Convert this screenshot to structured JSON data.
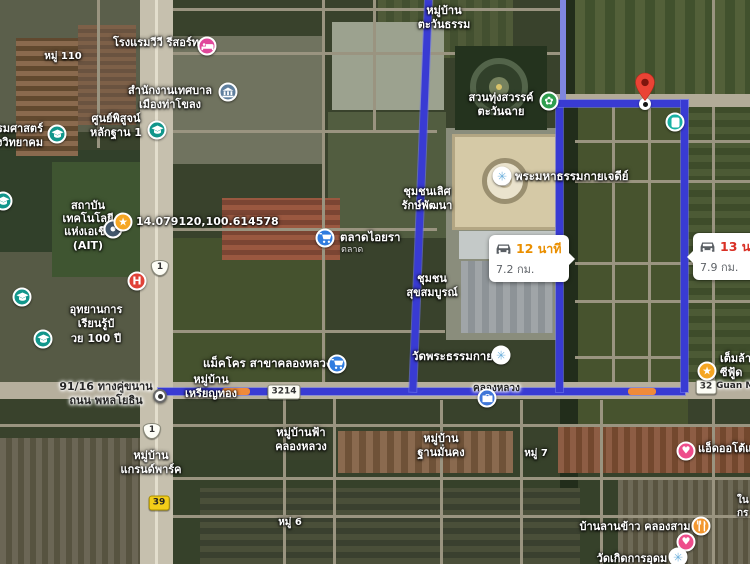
{
  "app": {
    "view": "satellite-map-with-driving-route"
  },
  "route": {
    "selected": {
      "duration": "12 นาที",
      "distance": "7.2 กม.",
      "duration_color": "#ea8f00"
    },
    "alternate": {
      "duration": "13 นาที",
      "distance": "7.9 กม.",
      "duration_color": "#d93025"
    },
    "polyline_color": "#393bd3",
    "polyline_color_secondary": "#7f86e0",
    "traffic_color": "#ef8a3a"
  },
  "shields": {
    "highway_1_north": "1",
    "highway_1_south": "1",
    "route_3214": "3214",
    "route_39": "39",
    "route_32": "32"
  },
  "labels": {
    "vv_resort": "โรงแรมวีวี รีสอร์ท",
    "moo_110": "หมู่ 110",
    "thakhlong_1": "สำนักงานเทศบาล",
    "thakhlong_2": "เมืองท่าโขลง",
    "forensic_1": "ศูนย์พิสูจน์",
    "forensic_2": "หลักฐาน 1",
    "school_1": "ธรรมศาสตร์",
    "school_2": "คลองหลวงวิทยาคม",
    "coordinates": "14.079120,100.614578",
    "ait_1": "สถาบัน",
    "ait_2": "เทคโนโลยี",
    "ait_3": "แห่งเอเชีย",
    "ait_4": "(AIT)",
    "puey_1": "อุทยานการ",
    "puey_2": "เรียนรู้ป๋",
    "puey_3": "วย 100 ปี",
    "aiyara": "ตลาดไอยรา",
    "aiyara_sub": "ตลาด",
    "tawantham_1": "หมู่บ้าน",
    "tawantham_2": "ตะวันธรรม",
    "park_1": "สวนทุ่งสวรรค์",
    "park_2": "ตะวันฉาย",
    "cedi": "พระมหาธรรมกายเจดีย์",
    "lertsak_1": "ชุมชนเลิศ",
    "lertsak_2": "รักษ์พัฒนา",
    "suksomboon_1": "ชุมชน",
    "suksomboon_2": "สุขสมบูรณ์",
    "wat_dhammakaya": "วัดพระธรรมกาย",
    "khlong_luang_road": "คลองหลวง",
    "makro": "แม็คโคร สาขาคลองหลวง",
    "rianthong_1": "หมู่บ้าน",
    "rianthong_2": "เหรียญทอง",
    "origin_1": "91/16 ทางคู่ขนาน",
    "origin_2": "ถนน พหลโยธิน",
    "grandpark_1": "หมู่บ้าน",
    "grandpark_2": "แกรนด์พาร์ค",
    "fah_1": "หมู่บ้านฟ้า",
    "fah_2": "คลองหลวง",
    "moo_6": "หมู่ 6",
    "thanmankong_1": "หมู่บ้าน",
    "thanmankong_2": "ฐานมั่นคง",
    "moo_7": "หมู่ 7",
    "lankhao": "บ้านลานข้าว คลองสาม",
    "temlan_1": "เต็มล้าน",
    "temlan_2": "ซีฟู้ด",
    "guan_m": "Guan M",
    "ad_auto": "แอ็ดออโต้แอร์",
    "wat_kerd": "วัดเกิดการอุดม",
    "edge_fragment_1": "ใน",
    "edge_fragment_2": "กร"
  },
  "icons": {
    "hotel": {
      "name": "bed-icon",
      "color": "#e0489b"
    },
    "city_hall": {
      "name": "bank-icon",
      "color": "#5f7f9e"
    },
    "school": {
      "name": "graduation-cap-icon",
      "color": "#11968b"
    },
    "hospital": {
      "name": "hospital-icon",
      "glyph": "H",
      "color": "#e04238"
    },
    "saved_star": {
      "name": "star-icon",
      "glyph": "★",
      "color": "#f5a623"
    },
    "navy_place": {
      "name": "place-icon",
      "color": "#41566b"
    },
    "market": {
      "name": "shopping-cart-icon",
      "color": "#2f7ce0"
    },
    "park": {
      "name": "flower-icon",
      "glyph": "✿",
      "color": "#2e9e4f"
    },
    "temple": {
      "name": "dharma-wheel-icon",
      "glyph": "✳",
      "color": "#ffffff",
      "glyph_color": "#6fb1dd"
    },
    "teal_poi": {
      "name": "storefront-icon",
      "color": "#18b1a3"
    },
    "gov_office": {
      "name": "briefcase-icon",
      "color": "#3f76d8"
    },
    "restaurant": {
      "name": "restaurant-icon",
      "color": "#f2962e"
    },
    "heart": {
      "name": "heart-icon",
      "glyph": "♥",
      "color": "#ee4d8b"
    },
    "destination": {
      "name": "destination-pin",
      "color": "#ea4335"
    }
  }
}
